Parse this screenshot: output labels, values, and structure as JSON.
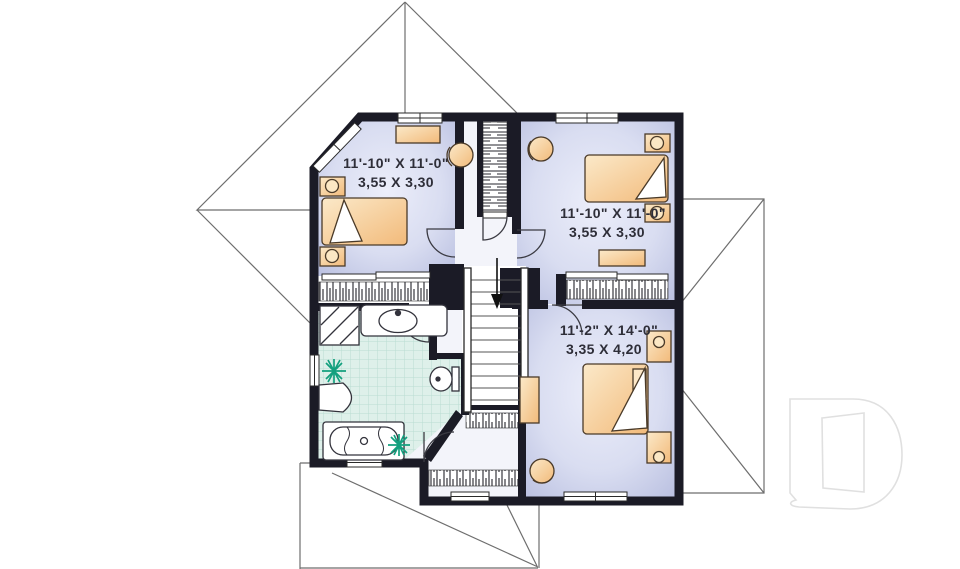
{
  "floor_plan": {
    "title": "second-floor plan",
    "rooms": [
      {
        "name": "bedroom-top-left",
        "label_imperial": "11'-10\" X 11'-0\"",
        "label_metric": "3,55 X 3,30"
      },
      {
        "name": "bedroom-top-right",
        "label_imperial": "11'-10\" X 11'-0\"",
        "label_metric": "3,55 X 3,30"
      },
      {
        "name": "master-bedroom",
        "label_imperial": "11'-2\" X 14'-0\"",
        "label_metric": "3,35 X 4,20"
      }
    ],
    "stairs": {
      "direction": "down",
      "symbol": "down-arrow"
    },
    "fixtures": [
      "bed",
      "pillow-fold",
      "nightstand-lamp",
      "dresser",
      "armchair",
      "closet-rod-hatch",
      "linen-closet",
      "sliding-closet-doors",
      "shower",
      "vanity-sink",
      "toilet",
      "bathtub",
      "plant",
      "window",
      "door-swing-arc",
      "roof-outline"
    ],
    "watermark": {
      "letter": "D"
    },
    "colors": {
      "wall": "#1b1b26",
      "bedroom_floor_edge": "#bcc2e2",
      "bedroom_floor_center": "#e9ebf8",
      "hall_floor": "#f3f4fa",
      "bath_tile": "#ddefe9",
      "bath_tile_line": "#b9ddd2",
      "furniture_orange": "#f3bd7e",
      "furniture_light": "#fbe7c4",
      "plant_green": "#13a07e",
      "roof_line_gray": "#6e6e6e",
      "watermark_gray": "#e0e0e0",
      "text": "#2e2e38"
    }
  }
}
